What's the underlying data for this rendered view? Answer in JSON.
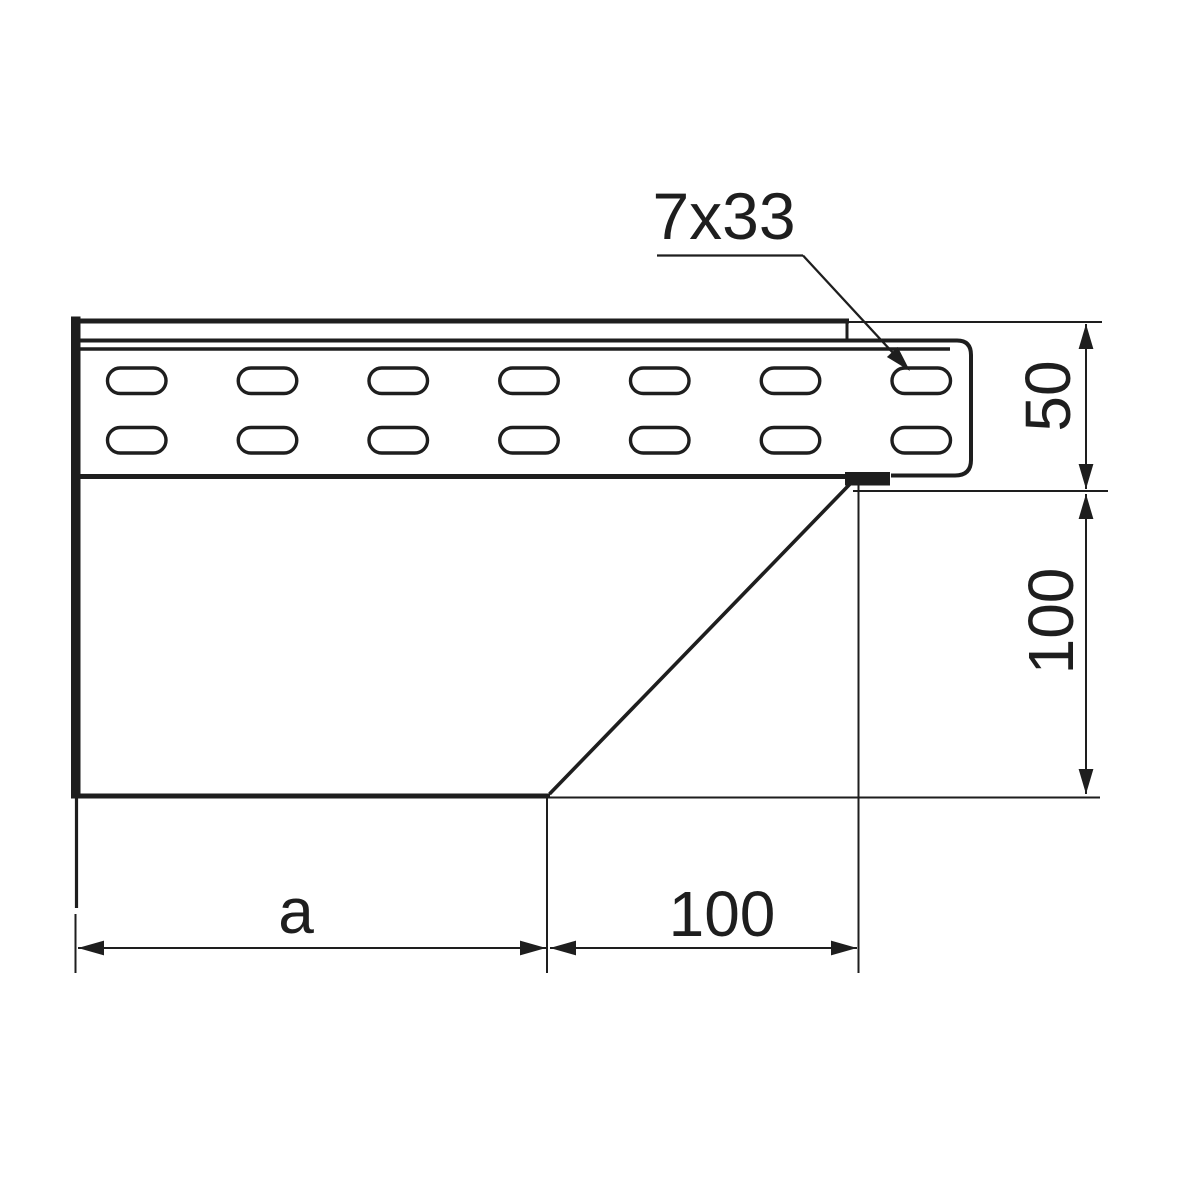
{
  "drawing": {
    "callout": {
      "label": "7x33"
    },
    "dimensions": {
      "rail_height": "50",
      "body_height": "100",
      "bottom_left_width": "a",
      "bottom_right_width": "100"
    },
    "slots": {
      "rows": 2,
      "columns": 7
    },
    "colors": {
      "line": "#1e1e1e",
      "background": "#ffffff"
    }
  }
}
